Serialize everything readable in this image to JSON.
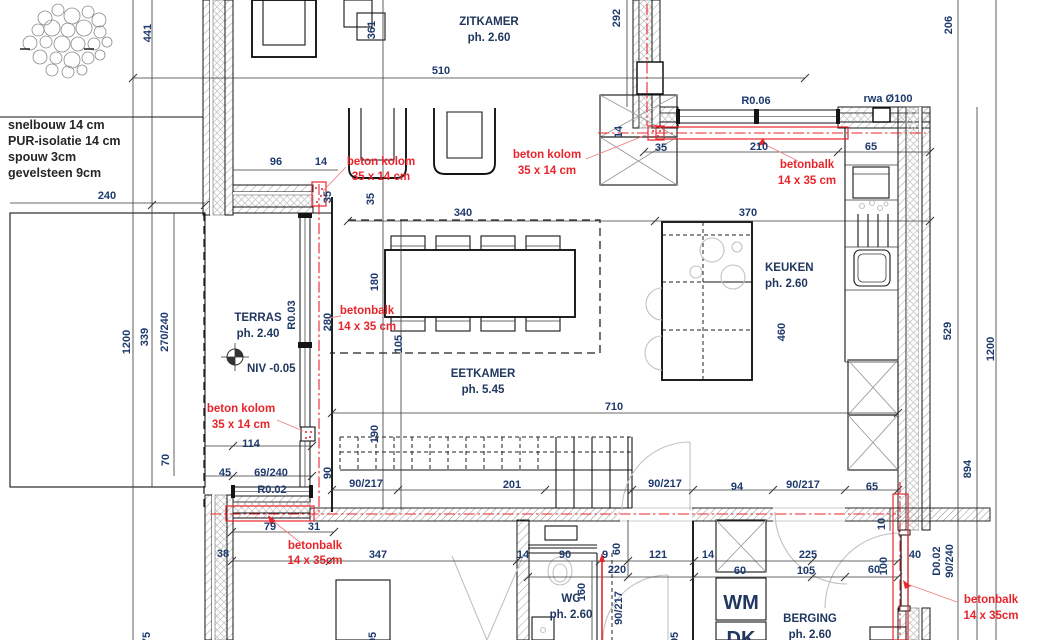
{
  "wall_note": {
    "l1": "snelbouw 14 cm",
    "l2": "PUR-isolatie 14 cm",
    "l3": "spouw 3cm",
    "l4": "gevelsteen 9cm"
  },
  "rooms": {
    "zitkamer": {
      "name": "ZITKAMER",
      "ph": "ph. 2.60"
    },
    "eetkamer": {
      "name": "EETKAMER",
      "ph": "ph. 5.45"
    },
    "keuken": {
      "name": "KEUKEN",
      "ph": "ph. 2.60"
    },
    "terras": {
      "name": "TERRAS",
      "ph": "ph. 2.40",
      "niv": "NIV -0.05"
    },
    "wc": {
      "name": "WC",
      "ph": "ph. 2.60"
    },
    "berging": {
      "name": "BERGING",
      "ph": "ph. 2.60"
    },
    "wm": "WM",
    "dk": "DK"
  },
  "red_notes": {
    "kolom": "beton kolom",
    "kolom_size": "35 x 14 cm",
    "balk": "betonbalk",
    "balk_size": "14 x 35 cm",
    "balk_size2": "14 x 35cm"
  },
  "refs": {
    "rwa": "rwa Ø100",
    "r006": "R0.06",
    "r003": "R0.03",
    "r002": "R0.02",
    "d002": "D0.02",
    "d002_size": "90/240"
  },
  "dims": {
    "v441": "441",
    "v510": "510",
    "v361": "361",
    "v292": "292",
    "v206": "206",
    "v96": "96",
    "v14": "14",
    "v240": "240",
    "v35": "35",
    "v210": "210",
    "v65": "65",
    "v340": "340",
    "v370": "370",
    "v1200": "1200",
    "v339": "339",
    "v270_240": "270/240",
    "v180": "180",
    "v105": "105",
    "v280": "280",
    "v460": "460",
    "v529": "529",
    "v894": "894",
    "v710": "710",
    "v190": "190",
    "v90": "90",
    "door": "90/217",
    "v201": "201",
    "v94": "94",
    "v70": "70",
    "v114": "114",
    "v45": "45",
    "v69_240": "69/240",
    "v79": "79",
    "v31": "31",
    "v38": "38",
    "v347": "347",
    "v9": "9",
    "v121": "121",
    "v220": "220",
    "v60": "60",
    "v160": "160",
    "v225": "225",
    "v100": "100",
    "v40": "40",
    "v10": "10",
    "v95": "95",
    "v75": "75"
  }
}
